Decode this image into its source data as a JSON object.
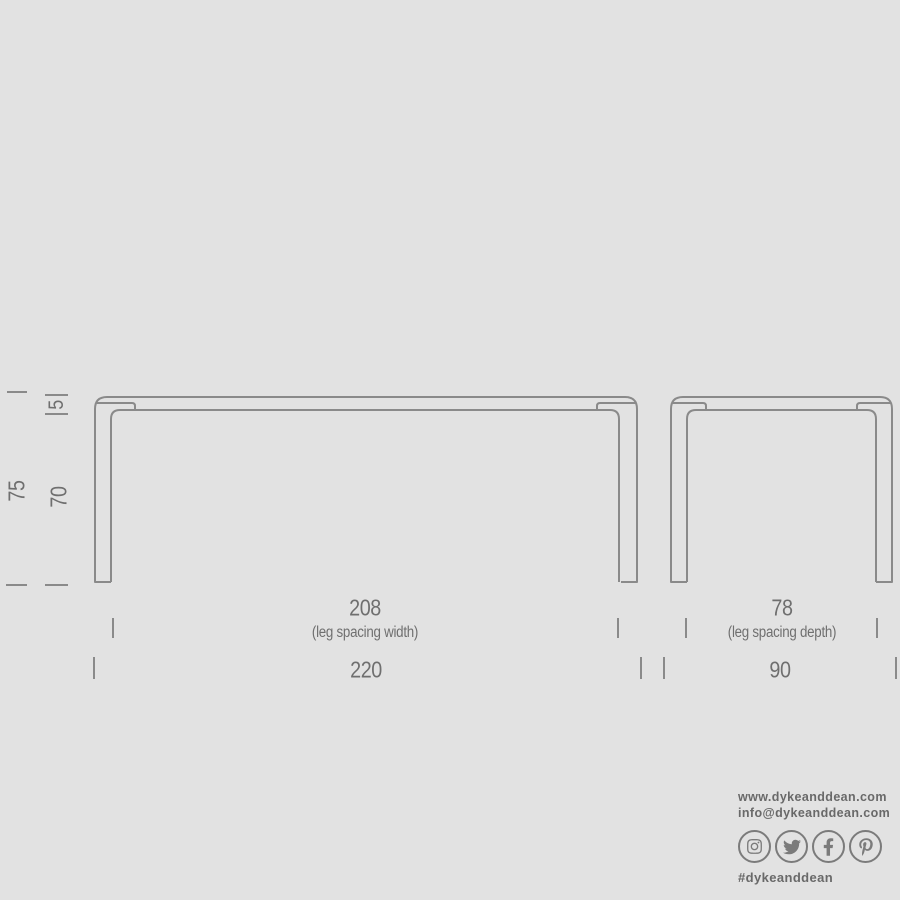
{
  "background_color": "#e2e2e2",
  "drawing": {
    "line_color": "#8a8a8a",
    "front_view": "table front elevation",
    "side_view": "table side elevation"
  },
  "dimensions": {
    "text_color": "#6f6f6f",
    "total_height": "75",
    "clearance_height": "70",
    "top_thickness": "5",
    "leg_spacing_width": "208",
    "leg_spacing_width_caption": "(leg spacing width)",
    "total_width": "220",
    "leg_spacing_depth": "78",
    "leg_spacing_depth_caption": "(leg spacing depth)",
    "total_depth": "90"
  },
  "branding": {
    "website": "www.dykeanddean.com",
    "email": "info@dykeanddean.com",
    "hashtag": "#dykeanddean",
    "text_color": "#696969",
    "icon_color": "#7b7b7b",
    "social_icons": [
      "instagram-icon",
      "twitter-icon",
      "facebook-icon",
      "pinterest-icon"
    ]
  }
}
